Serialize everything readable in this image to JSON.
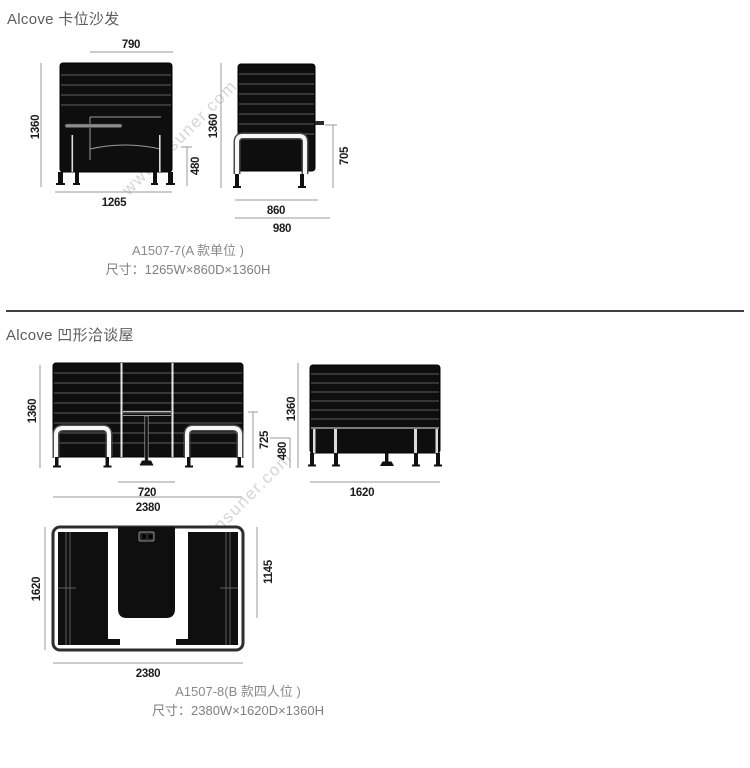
{
  "watermark": {
    "text": "www.insuner.com"
  },
  "section1": {
    "title": "Alcove 卡位沙发",
    "front": {
      "top_width": "790",
      "height": "1360",
      "seat_height": "480",
      "bottom_width": "1265"
    },
    "side": {
      "height": "1360",
      "armrest_height": "705",
      "depth_inner": "860",
      "depth_outer": "980"
    },
    "model": "A1507-7(A 款单位 )",
    "size": "尺寸：1265W×860D×1360H"
  },
  "section2": {
    "title": "Alcove 凹形洽谈屋",
    "front": {
      "height": "1360",
      "back_inner_height": "725",
      "seat_height": "480",
      "table_width": "720",
      "total_width": "2380"
    },
    "side": {
      "height": "1360",
      "depth": "1620"
    },
    "top": {
      "depth": "1620",
      "inner_depth": "1145",
      "width": "2380"
    },
    "model": "A1507-8(B 款四人位 )",
    "size": "尺寸：2380W×1620D×1360H"
  }
}
